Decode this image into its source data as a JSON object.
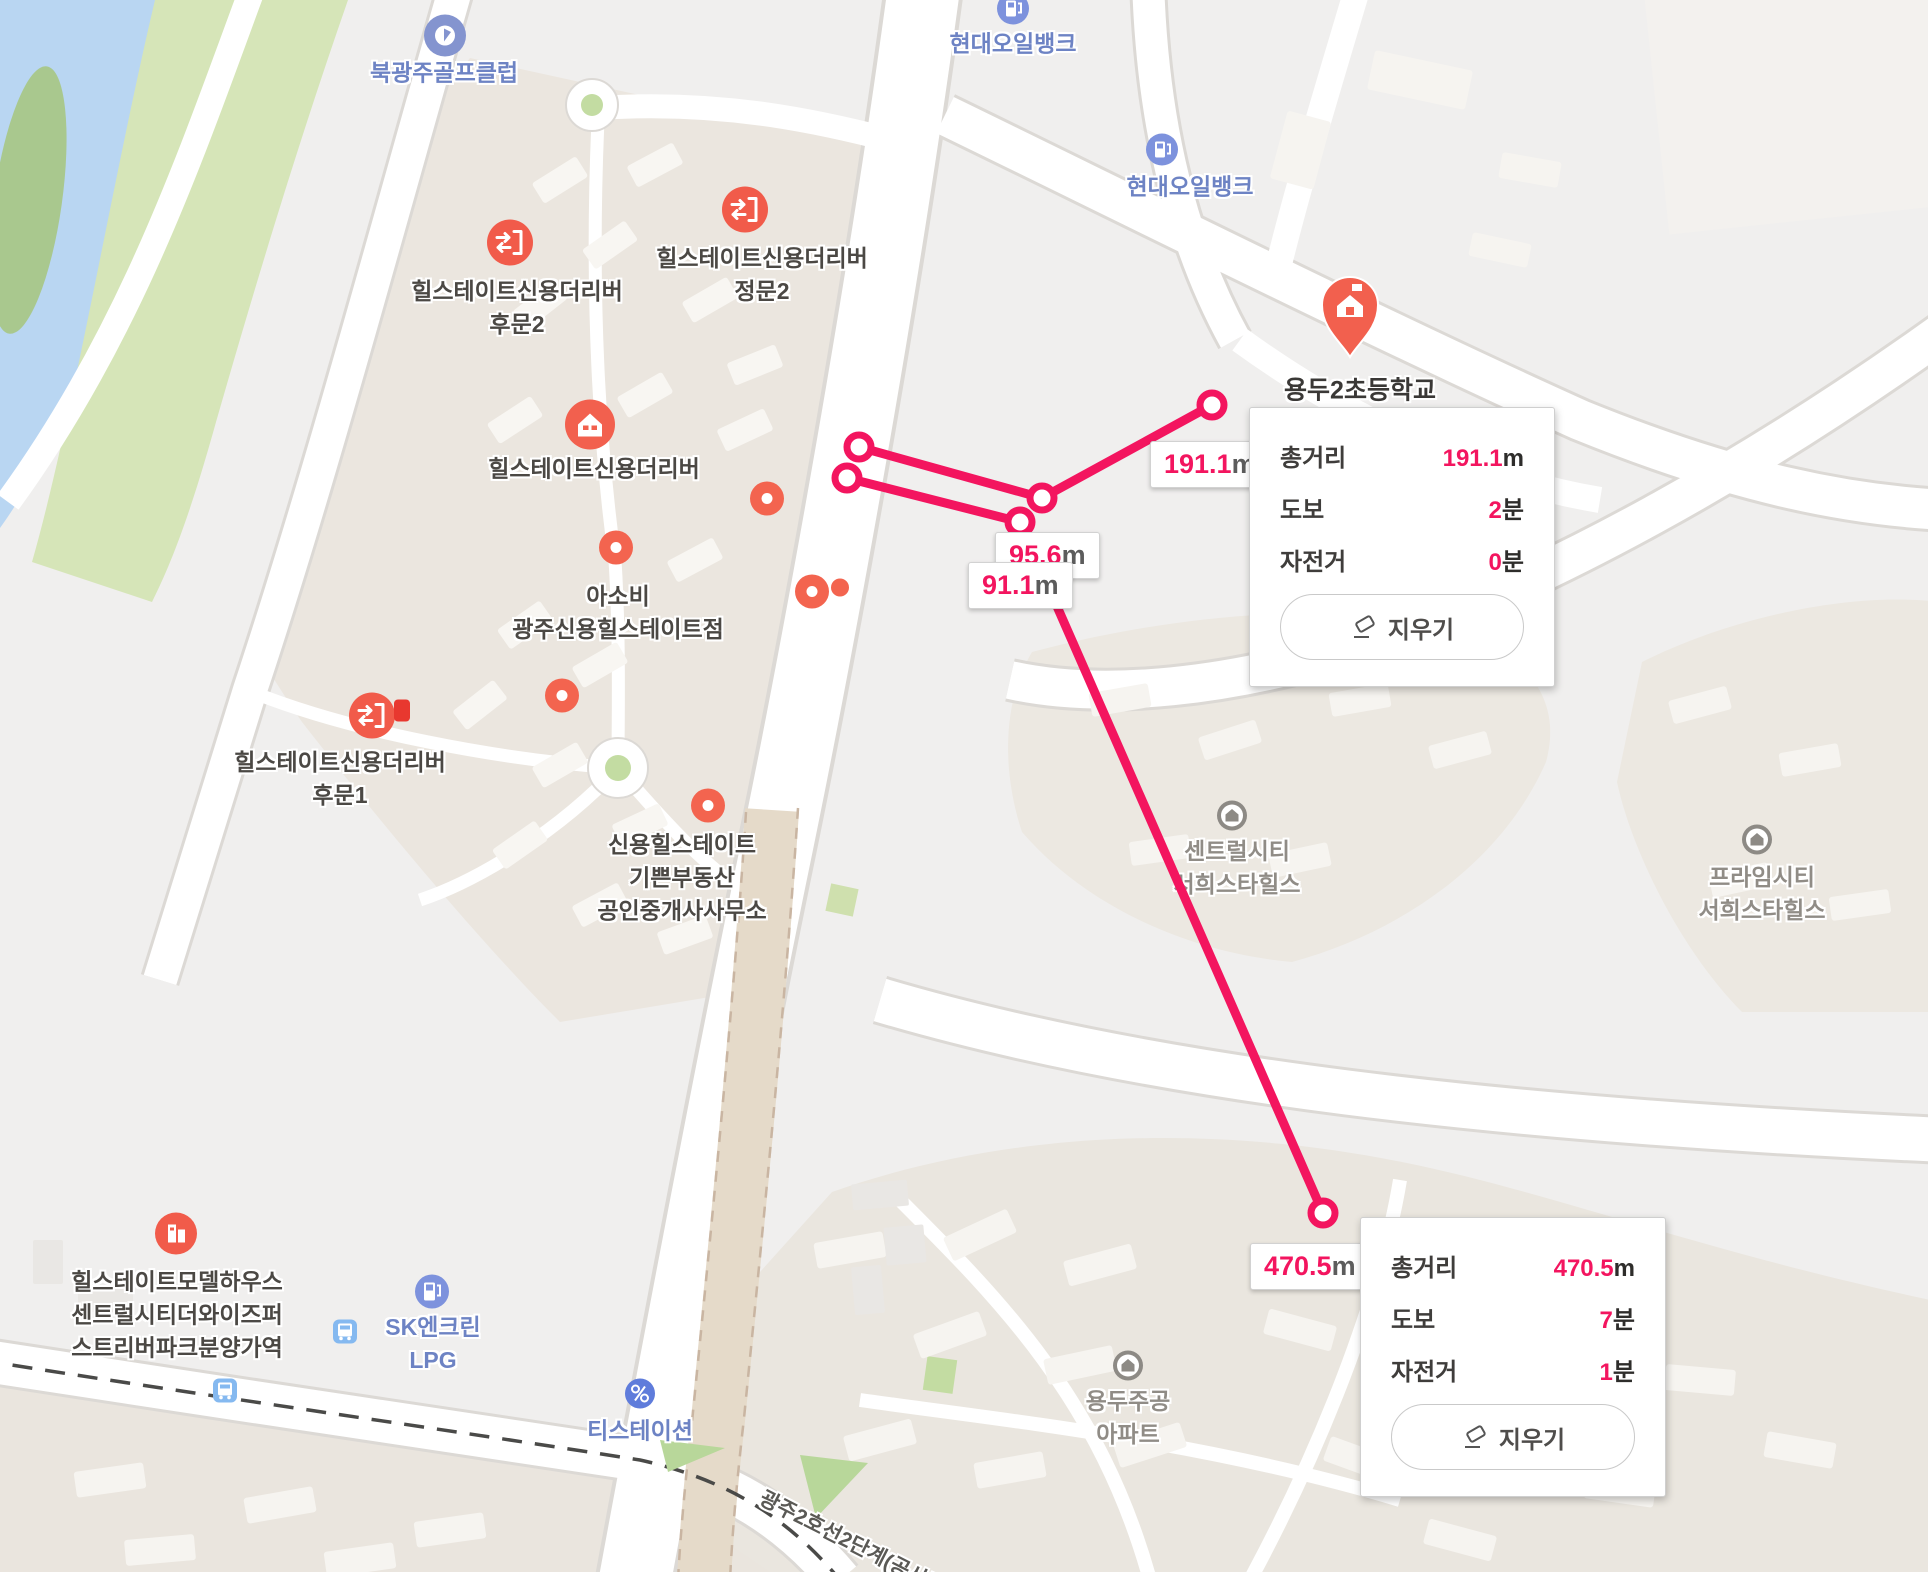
{
  "map": {
    "canvas_name": "naver-map-distance-measure",
    "colors": {
      "accent_pink": "#f3155f",
      "marker_orange": "#f15b4a",
      "poi_blue": "#6d83c4",
      "complex_beige": "#ebe6df",
      "water_blue": "#b9d6f2",
      "green": "#d6e5b8"
    },
    "place_labels": [
      {
        "lines": [
          "북광주골프클럽"
        ],
        "x": 444,
        "y": 73,
        "c": "blue"
      },
      {
        "lines": [
          "현대오일뱅크"
        ],
        "x": 1013,
        "y": 44,
        "c": "blue"
      },
      {
        "lines": [
          "현대오일뱅크"
        ],
        "x": 1190,
        "y": 187,
        "c": "blue"
      },
      {
        "lines": [
          "힐스테이트신용더리버",
          "후문2"
        ],
        "x": 517,
        "y": 308,
        "c": "dark"
      },
      {
        "lines": [
          "힐스테이트신용더리버",
          "정문2"
        ],
        "x": 762,
        "y": 275,
        "c": "dark"
      },
      {
        "lines": [
          "힐스테이트신용더리버"
        ],
        "x": 594,
        "y": 469,
        "c": "dark"
      },
      {
        "lines": [
          "아소비",
          "광주신용힐스테이트점"
        ],
        "x": 618,
        "y": 613,
        "c": "dark"
      },
      {
        "lines": [
          "힐스테이트신용더리버",
          "후문1"
        ],
        "x": 340,
        "y": 779,
        "c": "dark"
      },
      {
        "lines": [
          "신용힐스테이트",
          "기쁜부동산",
          "공인중개사사무소"
        ],
        "x": 682,
        "y": 878,
        "c": "dark"
      },
      {
        "lines": [
          "용두2초등학교"
        ],
        "x": 1360,
        "y": 391,
        "c": "school"
      },
      {
        "lines": [
          "센트럴시티",
          "서희스타힐스"
        ],
        "x": 1237,
        "y": 868,
        "c": "gray"
      },
      {
        "lines": [
          "프라임시티",
          "서희스타힐스"
        ],
        "x": 1762,
        "y": 894,
        "c": "gray"
      },
      {
        "lines": [
          "용두주공",
          "아파트"
        ],
        "x": 1128,
        "y": 1418,
        "c": "gray"
      },
      {
        "lines": [
          "힐스테이트모델하우스",
          "센트럴시티더와이즈퍼",
          "스트리버파크분양가역"
        ],
        "x": 177,
        "y": 1315,
        "c": "dark"
      },
      {
        "lines": [
          "SK엔크린",
          "LPG"
        ],
        "x": 433,
        "y": 1344,
        "c": "blue"
      },
      {
        "lines": [
          "티스테이션"
        ],
        "x": 640,
        "y": 1431,
        "c": "blue"
      }
    ],
    "construction_label": {
      "text": "광주2호선2단계(공사중)",
      "x": 855,
      "y": 1545,
      "rotation": 27
    },
    "markers": [
      {
        "type": "golf",
        "x": 445,
        "y": 38
      },
      {
        "type": "gas",
        "x": 1013,
        "y": 11
      },
      {
        "type": "gas",
        "x": 1162,
        "y": 152
      },
      {
        "type": "exit",
        "x": 510,
        "y": 245
      },
      {
        "type": "exit",
        "x": 745,
        "y": 212
      },
      {
        "type": "exit",
        "x": 372,
        "y": 718
      },
      {
        "type": "flag",
        "x": 402,
        "y": 713
      },
      {
        "type": "apartment",
        "x": 590,
        "y": 427
      },
      {
        "type": "dot",
        "x": 767,
        "y": 501
      },
      {
        "type": "dot",
        "x": 616,
        "y": 550
      },
      {
        "type": "dot",
        "x": 812,
        "y": 594
      },
      {
        "type": "dot-small",
        "x": 840,
        "y": 590
      },
      {
        "type": "dot",
        "x": 562,
        "y": 698
      },
      {
        "type": "dot",
        "x": 708,
        "y": 808
      },
      {
        "type": "school-pin",
        "x": 1350,
        "y": 364
      },
      {
        "type": "gray-building",
        "x": 1232,
        "y": 818
      },
      {
        "type": "gray-building",
        "x": 1757,
        "y": 842
      },
      {
        "type": "gray-building",
        "x": 1128,
        "y": 1368
      },
      {
        "type": "model-house",
        "x": 176,
        "y": 1236
      },
      {
        "type": "gas-lpg",
        "x": 432,
        "y": 1294
      },
      {
        "type": "bus",
        "x": 345,
        "y": 1334
      },
      {
        "type": "bus",
        "x": 225,
        "y": 1393
      },
      {
        "type": "tire",
        "x": 640,
        "y": 1396
      }
    ]
  },
  "measure": {
    "line_color": "#f3155f",
    "paths": [
      {
        "points": [
          [
            859,
            447
          ],
          [
            1042,
            498
          ],
          [
            1212,
            405
          ]
        ]
      },
      {
        "points": [
          [
            847,
            478
          ],
          [
            1020,
            522
          ],
          [
            1323,
            1213
          ]
        ]
      }
    ],
    "distance_labels": [
      {
        "value": "95.6",
        "unit": "m",
        "x": 995,
        "y": 532
      },
      {
        "value": "91.1",
        "unit": "m",
        "x": 968,
        "y": 562
      },
      {
        "value": "191.1",
        "unit": "m",
        "x": 1150,
        "y": 441
      },
      {
        "value": "470.5",
        "unit": "m",
        "x": 1250,
        "y": 1243
      }
    ]
  },
  "popups": [
    {
      "x": 1249,
      "y": 407,
      "rows": [
        {
          "label": "총거리",
          "value": "191.1",
          "unit": "m"
        },
        {
          "label": "도보",
          "value": "2",
          "unit": "분"
        },
        {
          "label": "자전거",
          "value": "0",
          "unit": "분"
        }
      ],
      "button_label": "지우기"
    },
    {
      "x": 1360,
      "y": 1217,
      "rows": [
        {
          "label": "총거리",
          "value": "470.5",
          "unit": "m"
        },
        {
          "label": "도보",
          "value": "7",
          "unit": "분"
        },
        {
          "label": "자전거",
          "value": "1",
          "unit": "분"
        }
      ],
      "button_label": "지우기"
    }
  ]
}
